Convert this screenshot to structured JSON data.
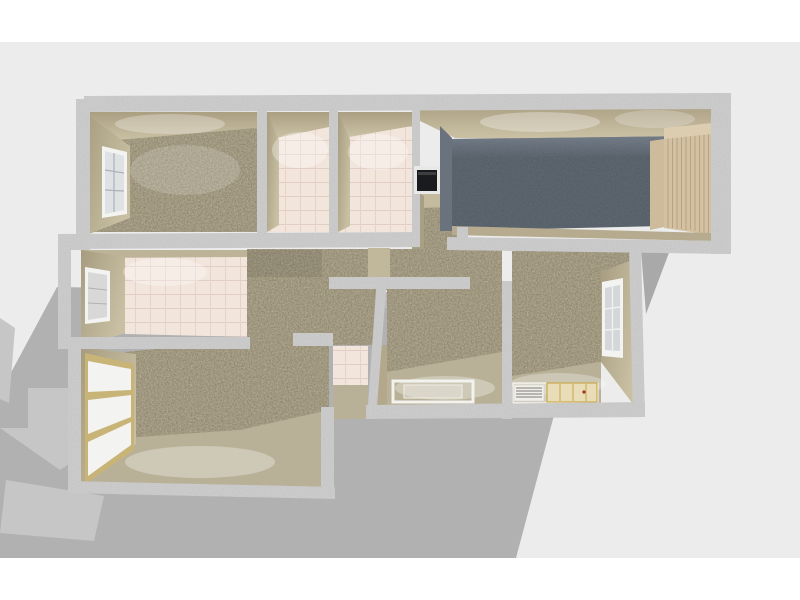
{
  "scene": {
    "type": "3d-floor-plan-render",
    "render_style": "dollhouse-top-down-perspective",
    "shadow_direction": "lower-left",
    "colors": {
      "page_bg": "#ffffff",
      "viewport_bg": "#ececec",
      "shadow": "#b1b1b1",
      "shadow_east": "#a9a9a9",
      "shadow_highlight": "#c6c6c6",
      "wall_top": "#cfcfcf",
      "wall_face": "#b3a88c",
      "wall_face_light": "#c6bda1",
      "carpet": "#a69d83",
      "carpet_speckle_dark": "#6e6550",
      "carpet_speckle_light": "#ded8c2",
      "tile": "#f2e6dc",
      "tile_grout": "#e1cdc4",
      "garage_floor": "#5d6670",
      "garage_wall": "#6a737d",
      "garage_door": "#d3c1a1",
      "garage_door_frame": "#cdbb9b",
      "window_white": "#f3f3f1",
      "window_glass": "#dfe2e4",
      "window_gold": "#c9b478",
      "appliance_black": "#1a1b1e",
      "floor_beige": "#b9b098",
      "outline_white": "#f2f2ee",
      "cabinet_gold": "#c8a84b",
      "cabinet_dot_red": "#a83224"
    },
    "rooms": [
      {
        "name": "bedroom-top-left",
        "floor": "carpet",
        "features": [
          "window-west"
        ]
      },
      {
        "name": "bathroom-small-1",
        "floor": "tile",
        "features": []
      },
      {
        "name": "bathroom-small-2",
        "floor": "tile",
        "features": []
      },
      {
        "name": "closet-niche",
        "floor": "carpet",
        "features": [
          "wall-appliance"
        ]
      },
      {
        "name": "garage",
        "floor": "dark-concrete",
        "features": [
          "slatted-garage-door-east"
        ]
      },
      {
        "name": "kitchen-middle-left",
        "floor": "tile",
        "features": [
          "window-west"
        ]
      },
      {
        "name": "hallway-center",
        "floor": "carpet",
        "features": []
      },
      {
        "name": "living-room-bottom-left",
        "floor": "carpet",
        "features": [
          "blind-window-west"
        ]
      },
      {
        "name": "closet-tiled-small",
        "floor": "tile",
        "features": []
      },
      {
        "name": "room-bottom-center",
        "floor": "carpet",
        "features": [
          "floor-table-outline"
        ]
      },
      {
        "name": "room-bottom-right",
        "floor": "carpet",
        "features": [
          "window-east",
          "kitchen-cabinet-outline"
        ]
      }
    ]
  }
}
